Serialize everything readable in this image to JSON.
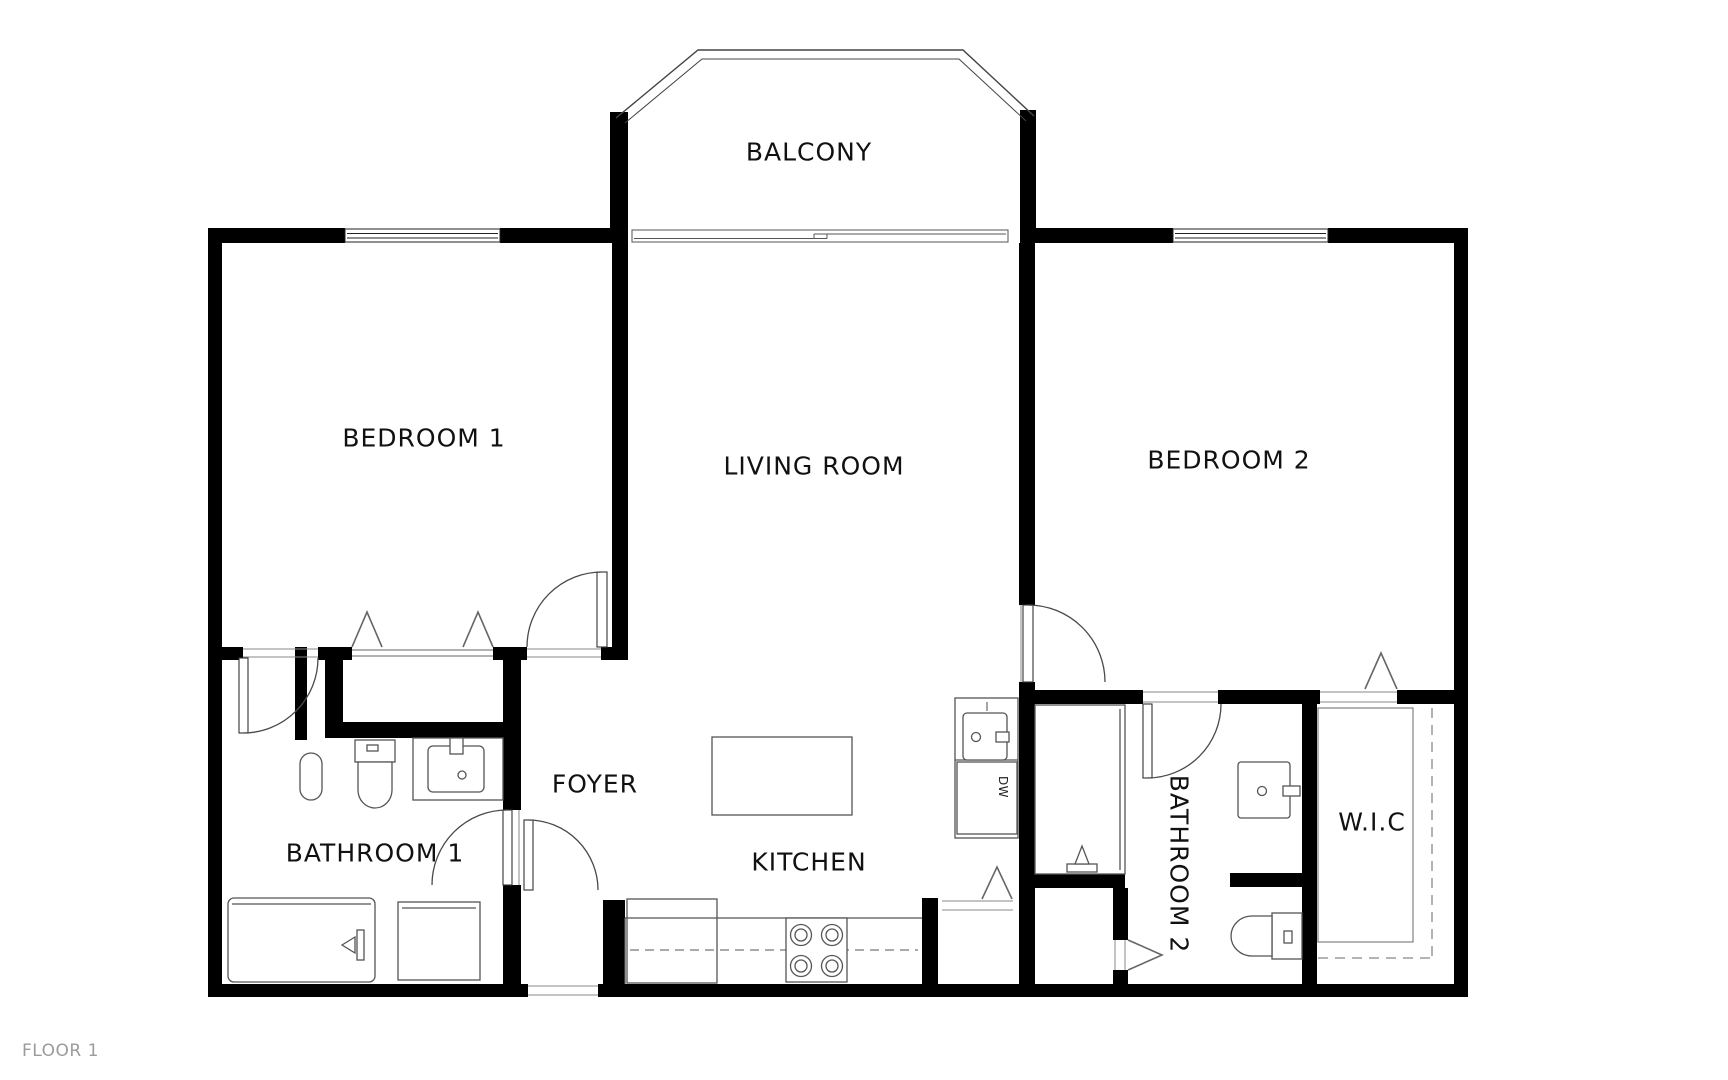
{
  "floor": {
    "label": "FLOOR 1"
  },
  "rooms": {
    "balcony": {
      "label": "BALCONY"
    },
    "bedroom1": {
      "label": "BEDROOM 1"
    },
    "living_room": {
      "label": "LIVING ROOM"
    },
    "bedroom2": {
      "label": "BEDROOM 2"
    },
    "bathroom1": {
      "label": "BATHROOM 1"
    },
    "foyer": {
      "label": "FOYER"
    },
    "kitchen": {
      "label": "KITCHEN"
    },
    "bathroom2": {
      "label": "BATHROOM 2"
    },
    "wic": {
      "label": "W.I.C"
    }
  },
  "appliances": {
    "dishwasher": "DW"
  },
  "colors": {
    "wall": "#000000",
    "line": "#4a4a4a",
    "label": "#111111",
    "floor_label": "#9b9b9b",
    "background": "#ffffff"
  }
}
